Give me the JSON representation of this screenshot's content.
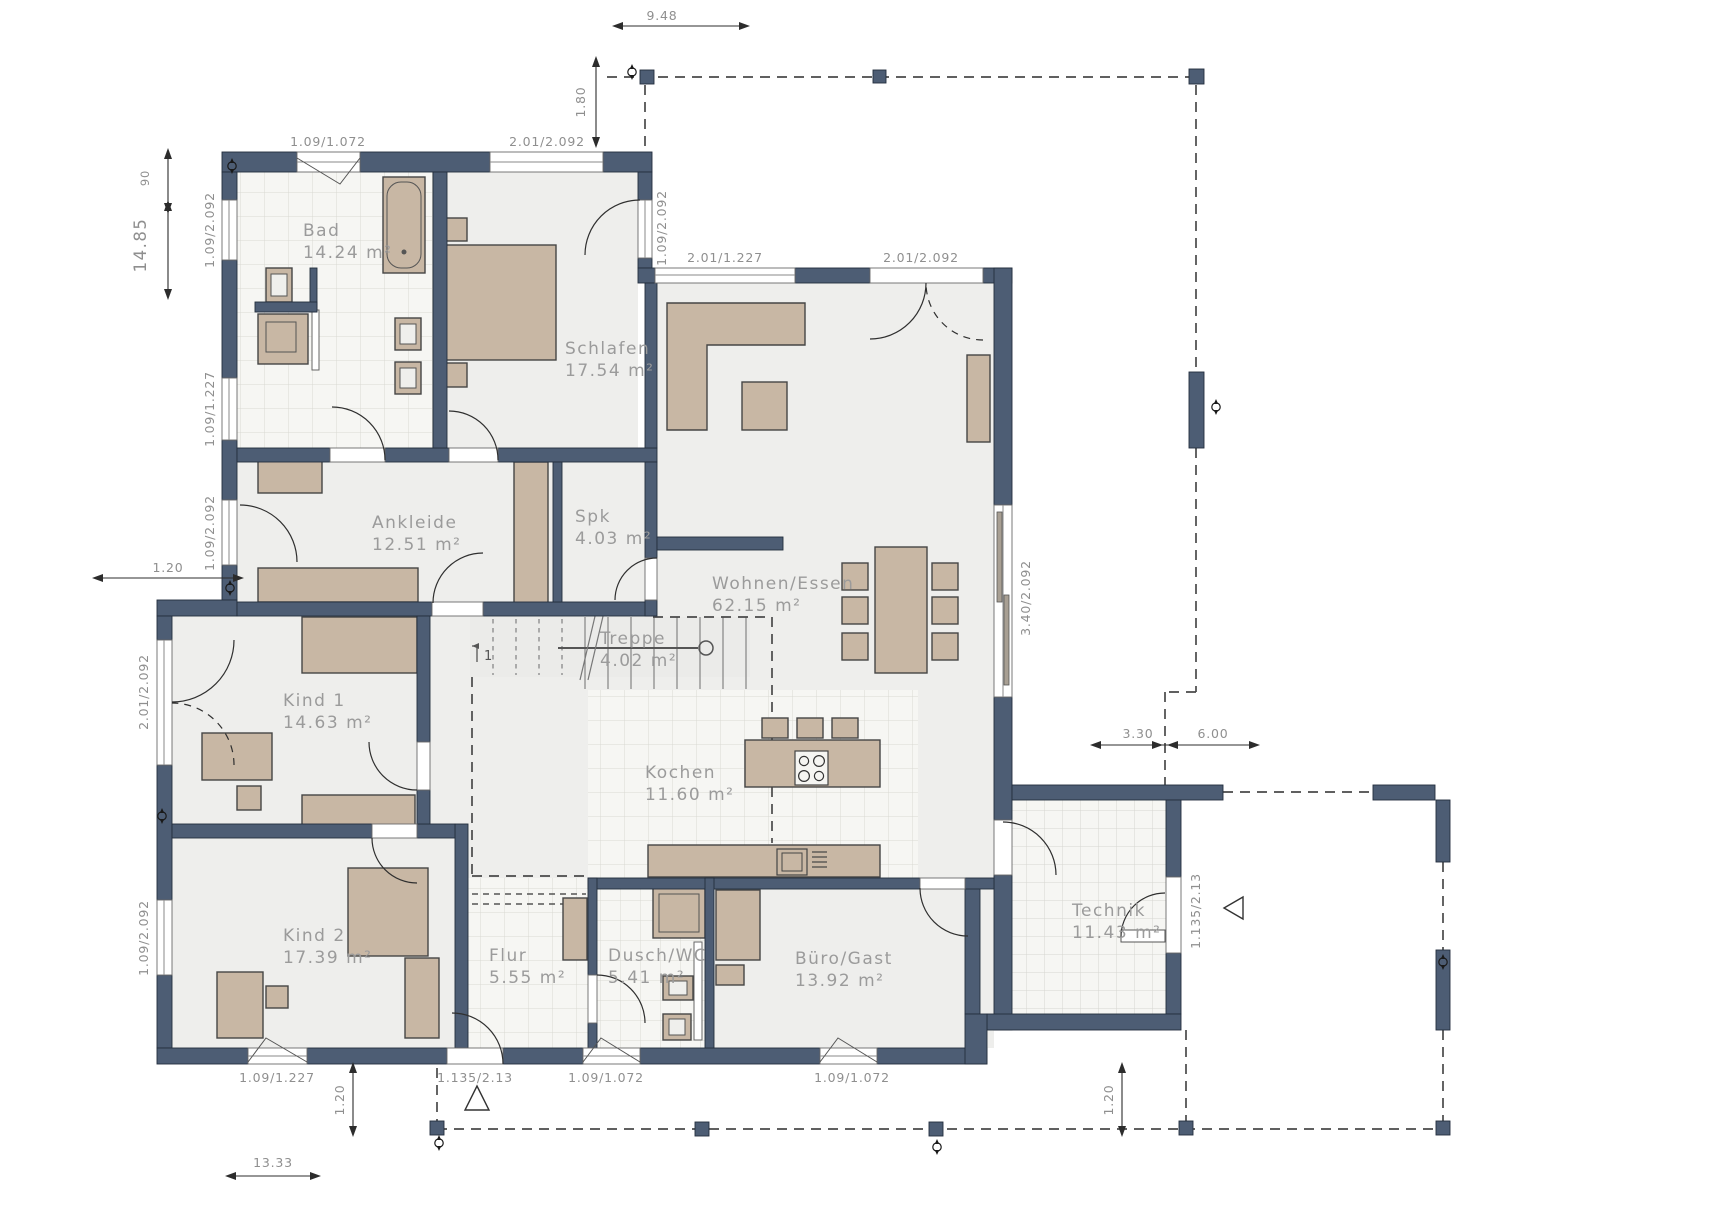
{
  "plan": {
    "type": "floor-plan",
    "rooms": [
      {
        "name": "Bad",
        "area": "14.24 m²"
      },
      {
        "name": "Schlafen",
        "area": "17.54 m²"
      },
      {
        "name": "Ankleide",
        "area": "12.51 m²"
      },
      {
        "name": "Spk",
        "area": "4.03 m²"
      },
      {
        "name": "Wohnen/Essen",
        "area": "62.15 m²"
      },
      {
        "name": "Treppe",
        "area": "4.02 m²"
      },
      {
        "name": "Kind 1",
        "area": "14.63 m²"
      },
      {
        "name": "Kochen",
        "area": "11.60 m²"
      },
      {
        "name": "Kind 2",
        "area": "17.39 m²"
      },
      {
        "name": "Flur",
        "area": "5.55 m²"
      },
      {
        "name": "Dusch/WC",
        "area": "5.41 m²"
      },
      {
        "name": "Büro/Gast",
        "area": "13.92 m²"
      },
      {
        "name": "Technik",
        "area": "11.43 m²"
      }
    ],
    "dims": [
      "9.48",
      "1.80",
      "1.09/1.072",
      "2.01/2.092",
      "1.09/2.092",
      "2.01/1.227",
      "2.01/2.092",
      "90",
      "14.85",
      "1.09/2.092",
      "1.09/1.227",
      "1.09/2.092",
      "1.20",
      "2.01/2.092",
      "1.09/2.092",
      "1.09/1.227",
      "1.20",
      "13.33",
      "1.135/2.13",
      "1.09/1.072",
      "1.09/1.072",
      "1.20",
      "3.40/2.092",
      "3.30",
      "6.00",
      "1.135/2.13",
      "1"
    ],
    "colors": {
      "wall": "#4d5d74",
      "furniture": "#c8b7a4",
      "floor": "#eeeeec",
      "tile": "#f6f6f3",
      "room_label": "#9b9b9b",
      "dim_label": "#8f8f8f"
    }
  }
}
